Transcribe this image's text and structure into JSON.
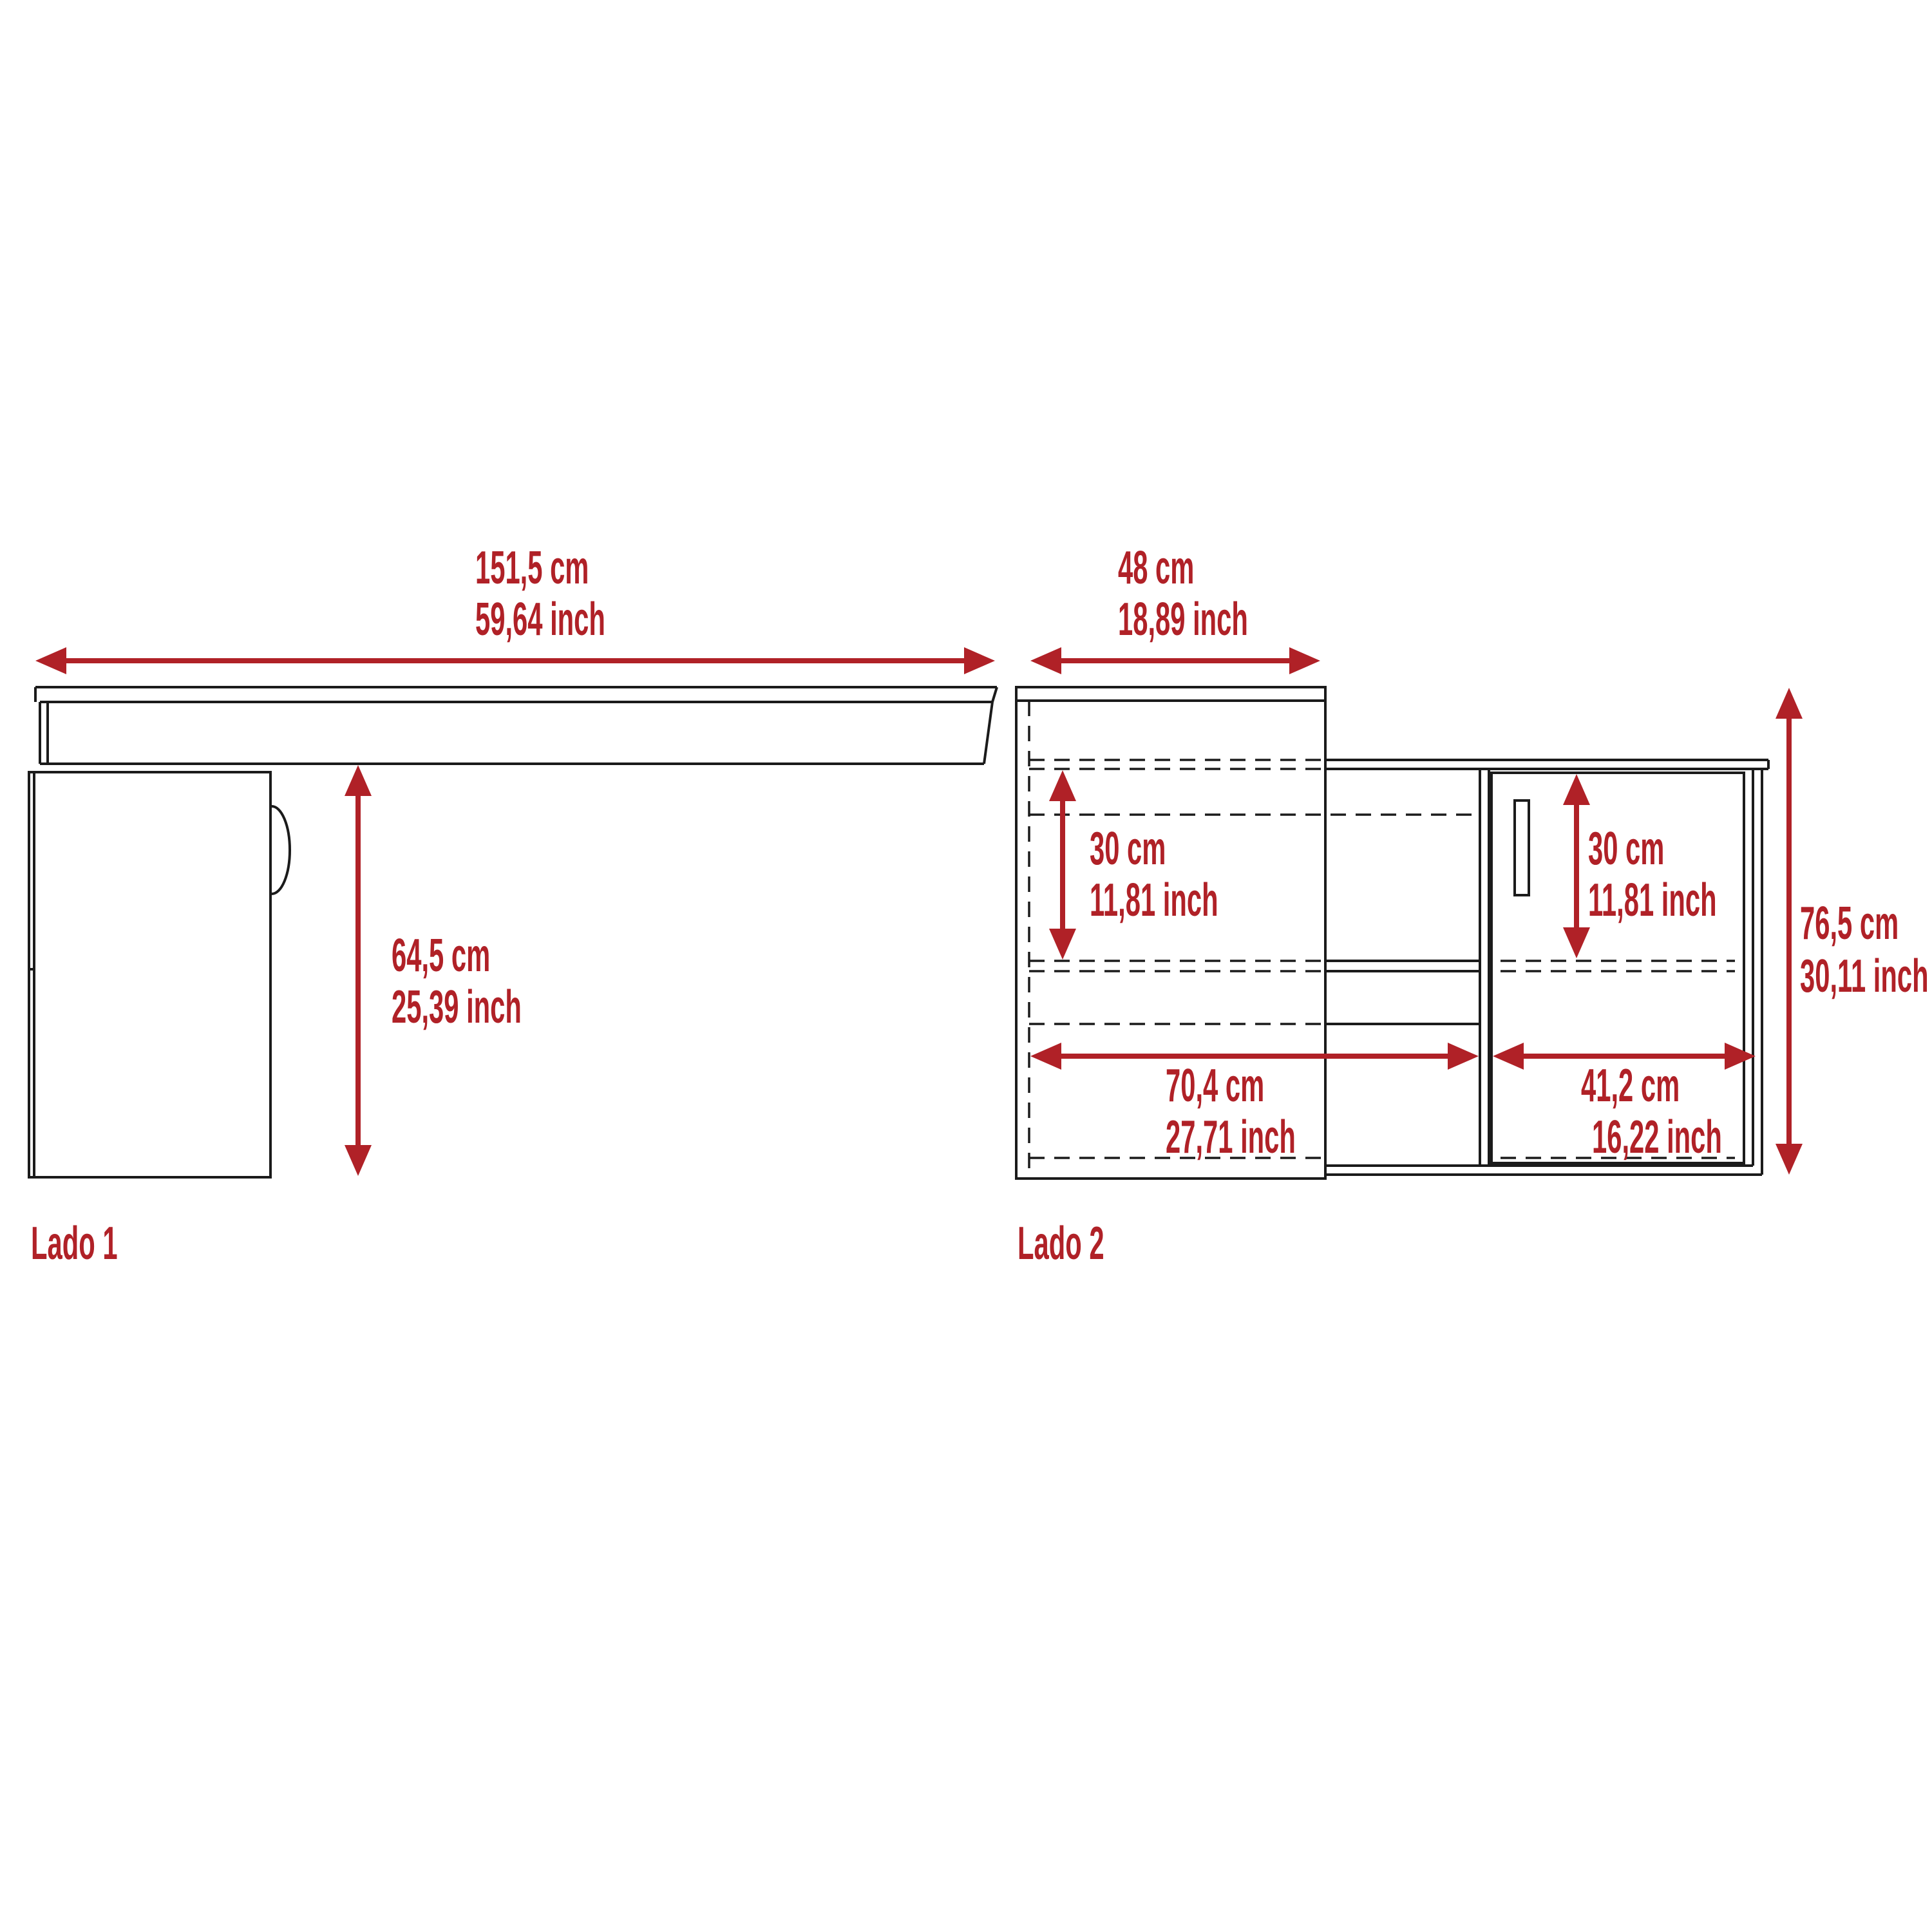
{
  "document": {
    "type": "furniture-dimension-diagram",
    "units": [
      "cm",
      "inch"
    ]
  },
  "colors": {
    "dimension_red": "#B02127",
    "outline_black": "#1B1B1B",
    "background": "#FFFFFF"
  },
  "views": {
    "lado1": {
      "label": "Lado 1",
      "width": {
        "cm": "151,5 cm",
        "inch": "59,64 inch"
      },
      "height": {
        "cm": "64,5 cm",
        "inch": "25,39 inch"
      }
    },
    "lado2": {
      "label": "Lado 2",
      "depth": {
        "cm": "48 cm",
        "inch": "18,89 inch"
      },
      "hutch_opening": {
        "cm": "30 cm",
        "inch": "11,81 inch"
      },
      "door_opening": {
        "cm": "30 cm",
        "inch": "11,81 inch"
      },
      "total_height": {
        "cm": "76,5 cm",
        "inch": "30,11 inch"
      },
      "open_width": {
        "cm": "70,4 cm",
        "inch": "27,71 inch"
      },
      "door_width": {
        "cm": "41,2 cm",
        "inch": "16,22 inch"
      }
    }
  }
}
